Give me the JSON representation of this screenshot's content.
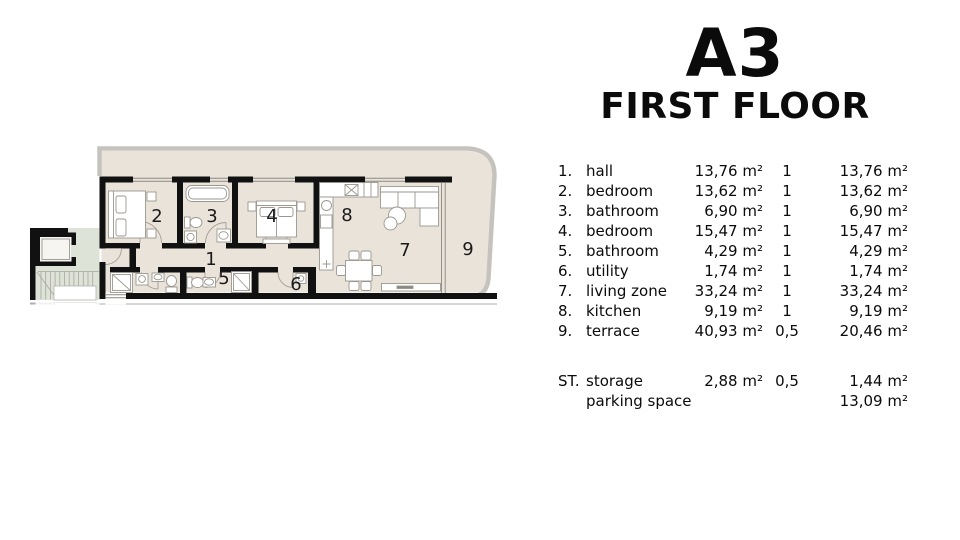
{
  "title": {
    "unit": "A3",
    "floor": "FIRST FLOOR"
  },
  "floor_plan": {
    "room_numbers": [
      "1",
      "2",
      "3",
      "4",
      "5",
      "6",
      "7",
      "8",
      "9"
    ]
  },
  "area_table": {
    "rows": [
      {
        "num": "1.",
        "name": "hall",
        "area": "13,76 m²",
        "coef": "1",
        "total": "13,76 m²"
      },
      {
        "num": "2.",
        "name": "bedroom",
        "area": "13,62 m²",
        "coef": "1",
        "total": "13,62 m²"
      },
      {
        "num": "3.",
        "name": "bathroom",
        "area": "6,90 m²",
        "coef": "1",
        "total": "6,90 m²"
      },
      {
        "num": "4.",
        "name": "bedroom",
        "area": "15,47 m²",
        "coef": "1",
        "total": "15,47 m²"
      },
      {
        "num": "5.",
        "name": "bathroom",
        "area": "4,29 m²",
        "coef": "1",
        "total": "4,29 m²"
      },
      {
        "num": "6.",
        "name": "utility",
        "area": "1,74 m²",
        "coef": "1",
        "total": "1,74 m²"
      },
      {
        "num": "7.",
        "name": "living zone",
        "area": "33,24 m²",
        "coef": "1",
        "total": "33,24 m²"
      },
      {
        "num": "8.",
        "name": "kitchen",
        "area": "9,19 m²",
        "coef": "1",
        "total": "9,19 m²"
      },
      {
        "num": "9.",
        "name": "terrace",
        "area": "40,93 m²",
        "coef": "0,5",
        "total": "20,46 m²"
      }
    ],
    "summary_rows": [
      {
        "num": "ST.",
        "name": "storage",
        "area": "2,88 m²",
        "coef": "0,5",
        "total": "1,44 m²"
      },
      {
        "num": "",
        "name": "parking space",
        "area": "",
        "coef": "",
        "total": "13,09 m²"
      }
    ]
  },
  "colors": {
    "wall": "#111111",
    "floor": "#eae3da",
    "common_area": "#dee3d8",
    "outline": "#c6c3bf",
    "text": "#0b0b0b"
  }
}
